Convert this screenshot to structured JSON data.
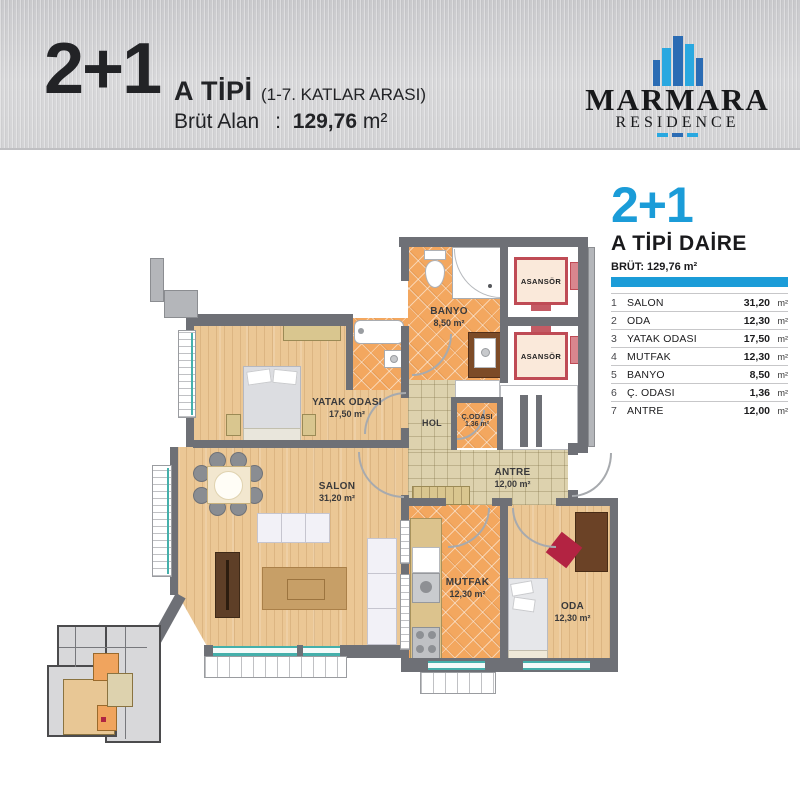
{
  "header": {
    "type": "2+1",
    "title": "A TİPİ",
    "subtitle": "(1-7. KATLAR ARASI)",
    "gross_label": "Brüt Alan",
    "gross_sep": ":",
    "gross_value": "129,76",
    "gross_unit": "m²"
  },
  "logo": {
    "name": "MARMARA",
    "subname": "RESIDENCE"
  },
  "legend": {
    "type": "2+1",
    "title": "A TİPİ DAİRE",
    "gross": "BRÜT: 129,76 m²",
    "rooms": [
      {
        "no": "1",
        "name": "SALON",
        "area": "31,20",
        "unit": "m²"
      },
      {
        "no": "2",
        "name": "ODA",
        "area": "12,30",
        "unit": "m²"
      },
      {
        "no": "3",
        "name": "YATAK ODASI",
        "area": "17,50",
        "unit": "m²"
      },
      {
        "no": "4",
        "name": "MUTFAK",
        "area": "12,30",
        "unit": "m²"
      },
      {
        "no": "5",
        "name": "BANYO",
        "area": "8,50",
        "unit": "m²"
      },
      {
        "no": "6",
        "name": "Ç. ODASI",
        "area": "1,36",
        "unit": "m²"
      },
      {
        "no": "7",
        "name": "ANTRE",
        "area": "12,00",
        "unit": "m²"
      }
    ]
  },
  "plan": {
    "rooms": [
      {
        "label": "BANYO",
        "area": "8,50 m²"
      },
      {
        "label": "YATAK ODASI",
        "area": "17,50 m²"
      },
      {
        "label": "SALON",
        "area": "31,20 m²"
      },
      {
        "label": "MUTFAK",
        "area": "12,30 m²"
      },
      {
        "label": "ODA",
        "area": "12,30 m²"
      },
      {
        "label": "ANTRE",
        "area": "12,00 m²"
      },
      {
        "label": "Ç.ODASI",
        "area": "1,36 m²"
      },
      {
        "label": "HOL",
        "area": ""
      }
    ],
    "elevator_label": "ASANSÖR"
  },
  "colors": {
    "brand_blue": "#1b9cd8",
    "logo_blue_dark": "#2b6cb4",
    "logo_blue_light": "#29a8e0",
    "tile_orange": "#f3a75f",
    "tile_beige": "#ddd2ae",
    "wood": "#ebc795",
    "wall_gray": "#6e7076",
    "elevator_red": "#bf4b55",
    "window_teal": "#45b0ab"
  }
}
